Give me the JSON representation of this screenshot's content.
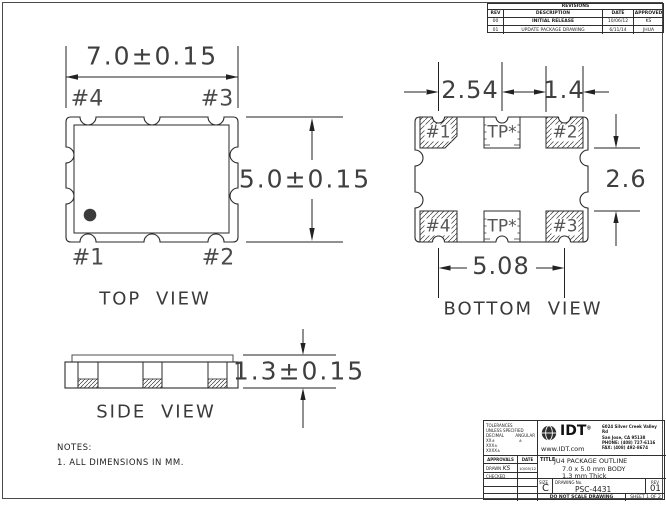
{
  "top_view": {
    "title": "TOP VIEW",
    "width_dim": "7.0±0.15",
    "height_dim": "5.0±0.15",
    "pin_top_left": "#4",
    "pin_top_right": "#3",
    "pin_bottom_left": "#1",
    "pin_bottom_right": "#2"
  },
  "bottom_view": {
    "title": "BOTTOM VIEW",
    "pitch_dim": "2.54",
    "pad_width_dim": "1.4",
    "row_gap_dim": "2.6",
    "span_dim": "5.08",
    "pad_top_left": "#1",
    "pad_top_center": "TP*",
    "pad_top_right": "#2",
    "pad_bottom_left": "#4",
    "pad_bottom_center": "TP*",
    "pad_bottom_right": "#3"
  },
  "side_view": {
    "title": "SIDE VIEW",
    "thickness_dim": "1.3±0.15"
  },
  "notes": {
    "heading": "NOTES:",
    "item1": "1. ALL DIMENSIONS IN MM."
  },
  "revisions": {
    "title": "REVISIONS",
    "col_rev": "REV",
    "col_description": "DESCRIPTION",
    "col_date": "DATE",
    "col_approved": "APPROVED",
    "rows": [
      {
        "rev": "00",
        "description": "INITIAL RELEASE",
        "date": "10/06/12",
        "approved": "KS"
      },
      {
        "rev": "01",
        "description": "UPDATE PACKAGE DRAWING",
        "date": "6/11/14",
        "approved": "JHUA"
      }
    ]
  },
  "title_block": {
    "tolerances": {
      "header1": "TOLERANCES",
      "header2": "UNLESS SPECIFIED",
      "decimal_label": "DECIMAL",
      "angular_label": "ANGULAR",
      "dec1": "XX±",
      "dec2": "XXX±",
      "dec3": "XXXX±",
      "ang1": "±"
    },
    "approvals": {
      "approvals_label": "APPROVALS",
      "date_label": "DATE",
      "drawn_label": "DRAWN",
      "drawn_sig": "KS",
      "drawn_date": "10/05/12",
      "checked_label": "CHECKED"
    },
    "company": {
      "name": "IDT",
      "reg": "®",
      "website": "www.IDT.com",
      "addr1": "6024 Silver Creek Valley Rd",
      "addr2": "San Jose, CA 95138",
      "addr3": "PHONE: (408) 727-6116",
      "addr4": "FAX: (408) 492-8674"
    },
    "title": {
      "label": "TITLE",
      "line1": "JU4 PACKAGE OUTLINE",
      "line2": "7.0 x 5.0 mm BODY",
      "line3": "1.3 mm Thick"
    },
    "size": {
      "label": "SIZE",
      "value": "C"
    },
    "drawing_no": {
      "label": "DRAWING No.",
      "value": "PSC-4431"
    },
    "rev": {
      "label": "REV",
      "value": "01"
    },
    "footer": {
      "scale_note": "DO NOT SCALE DRAWING",
      "sheet": "SHEET 1 OF 2"
    }
  }
}
